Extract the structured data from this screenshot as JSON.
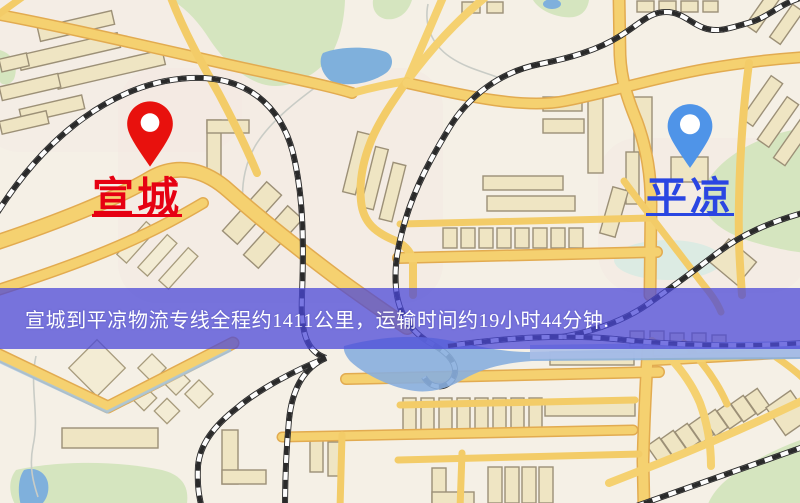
{
  "banner": {
    "text": "宣城到平凉物流专线全程约1411公里，运输时间约19小时44分钟.",
    "background_color": "#4a48d8",
    "background_opacity": 0.74,
    "text_color": "#ffffff"
  },
  "markers": {
    "origin": {
      "label": "宣城",
      "pin_color": "#e8110d",
      "label_color": "#e60012"
    },
    "destination": {
      "label": "平凉",
      "pin_color": "#4f94e8",
      "label_color": "#2a46e2"
    }
  },
  "map": {
    "type": "street-map",
    "colors": {
      "background": "#f5f0e6",
      "road_fill": "#f5d170",
      "road_minor": "#f3cc68",
      "road_casing": "#e2ab50",
      "building_fill": "#efe5c3",
      "building_stroke": "#9c9077",
      "park_green": "#d5e5bf",
      "water_blue": "#7fb0dc",
      "river_band": "#a9bde8",
      "railway": "#2a2a2a"
    }
  }
}
